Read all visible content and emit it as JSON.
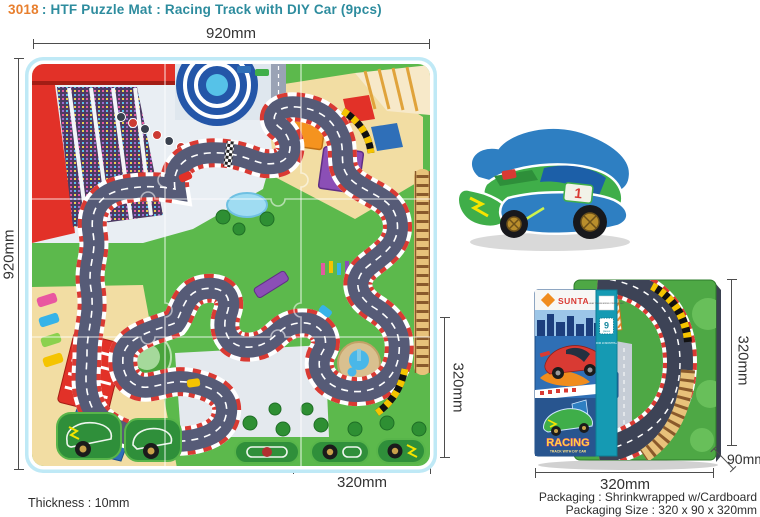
{
  "title": {
    "code": "3018",
    "rest": ": HTF Puzzle Mat : Racing Track with DIY Car (9pcs)"
  },
  "dimensions": {
    "mat_width": "920mm",
    "mat_height": "920mm",
    "tile_width": "320mm",
    "tile_height": "320mm",
    "box_width": "320mm",
    "box_height": "320mm",
    "box_depth": "90mm"
  },
  "notes": {
    "thickness": "Thickness : 10mm",
    "packaging": "Packaging : Shrinkwrapped w/Cardboard",
    "packaging_size": "Packaging Size : 320 x 90 x 320mm"
  },
  "box_sleeve": {
    "brand": "SUNTA",
    "badge_number": "9",
    "badge_caption": "pieces",
    "age_note": "FOR 10 MONTHS+",
    "strip_note": "HEAT TRANSFERRED PRINTED MAT",
    "art_title": "RACING",
    "art_subtitle": "TRACK WITH DIY CAR"
  },
  "car": {
    "number": "1"
  },
  "colors": {
    "code_orange": "#e87f2e",
    "title_teal": "#2d8c9e",
    "mat_green": "#5cb94c",
    "track_gray": "#565b77",
    "curb_red": "#d93a33",
    "sand": "#f2dda3",
    "edge_blue": "#bfe9f6"
  }
}
